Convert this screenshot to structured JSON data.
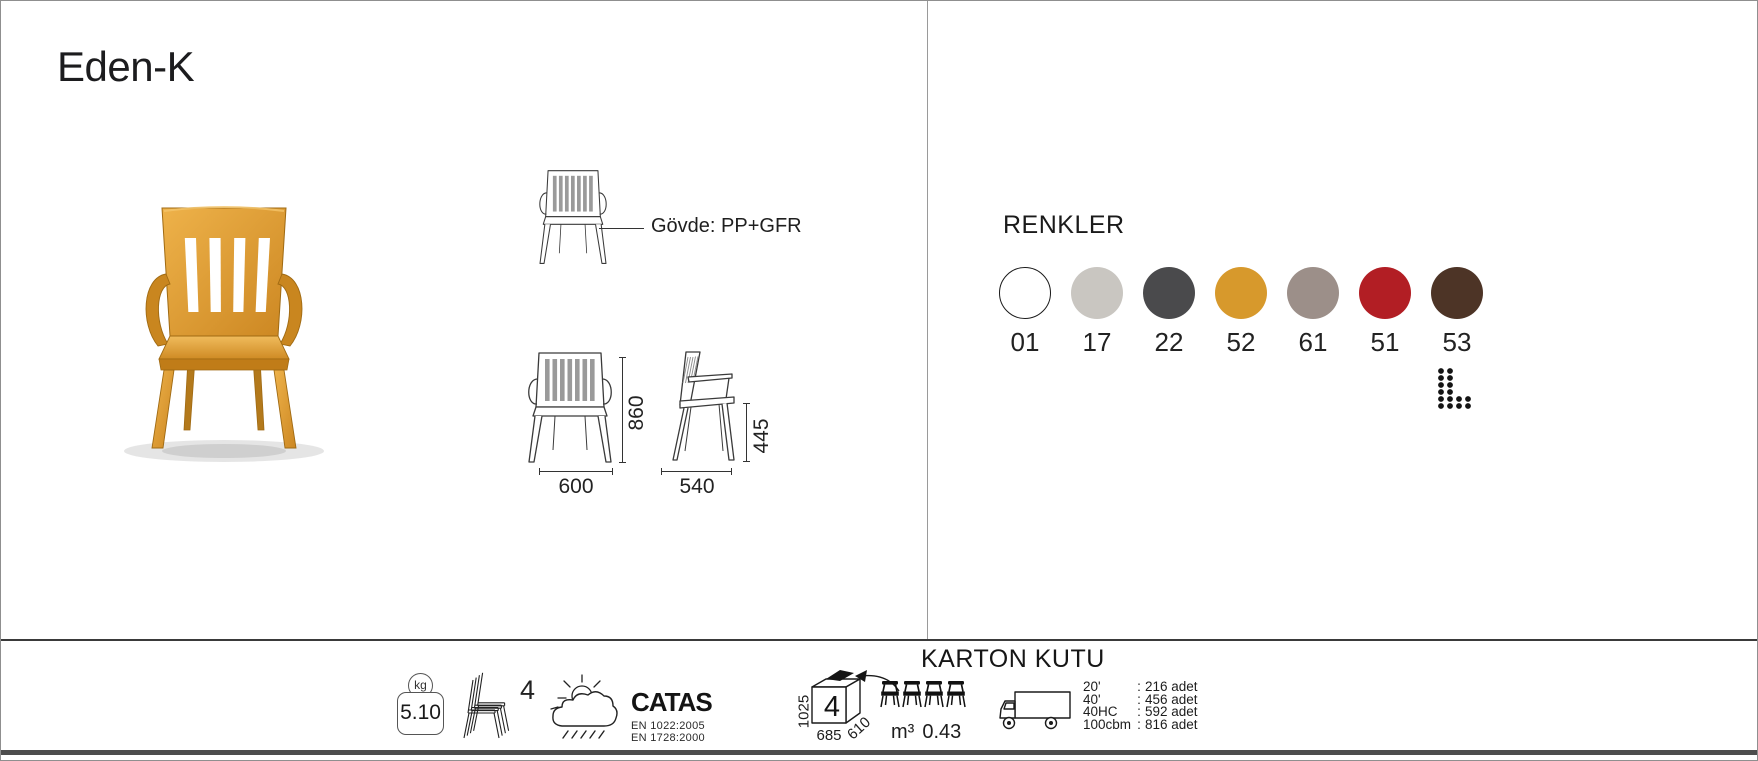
{
  "title": "Eden-K",
  "product_drawing": {
    "material_label": "Gövde: PP+GFR",
    "dims": {
      "height": "860",
      "width": "600",
      "depth": "540",
      "seat_height": "445"
    }
  },
  "photo": {
    "chair_color": "#dd9e35"
  },
  "colors_section": {
    "title": "RENKLER",
    "swatches": [
      {
        "code": "01",
        "hex": "#ffffff",
        "outlined": true
      },
      {
        "code": "17",
        "hex": "#c9c6c1",
        "outlined": false
      },
      {
        "code": "22",
        "hex": "#4a4a4c",
        "outlined": false
      },
      {
        "code": "52",
        "hex": "#d7992c",
        "outlined": false
      },
      {
        "code": "61",
        "hex": "#9c8f89",
        "outlined": false
      },
      {
        "code": "51",
        "hex": "#b21e24",
        "outlined": false
      },
      {
        "code": "53",
        "hex": "#4d3426",
        "outlined": false
      }
    ]
  },
  "footer": {
    "weight_unit": "kg",
    "weight_value": "5.10",
    "stack_count": "4",
    "certs": {
      "brand": "CATAS",
      "line1": "EN 1022:2005",
      "line2": "EN 1728:2000"
    },
    "carton": {
      "title": "KARTON KUTU",
      "height": "1025",
      "width": "685",
      "depth": "610",
      "qty": "4",
      "volume_unit": "m³",
      "volume_value": "0.43"
    },
    "capacity": [
      {
        "label": "20'",
        "sep": ":",
        "value": "216 adet"
      },
      {
        "label": "40'",
        "sep": ":",
        "value": "456 adet"
      },
      {
        "label": "40HC",
        "sep": ":",
        "value": "592 adet"
      },
      {
        "label": "100cbm",
        "sep": ":",
        "value": "816 adet"
      }
    ]
  },
  "icons": {
    "weight": "kg-weight-badge",
    "stacking": "stacked-chairs",
    "weather": "outdoor-use-sun-cloud-rain",
    "box": "carton-box",
    "truck": "delivery-truck",
    "logo": "dotted-l-mark"
  }
}
